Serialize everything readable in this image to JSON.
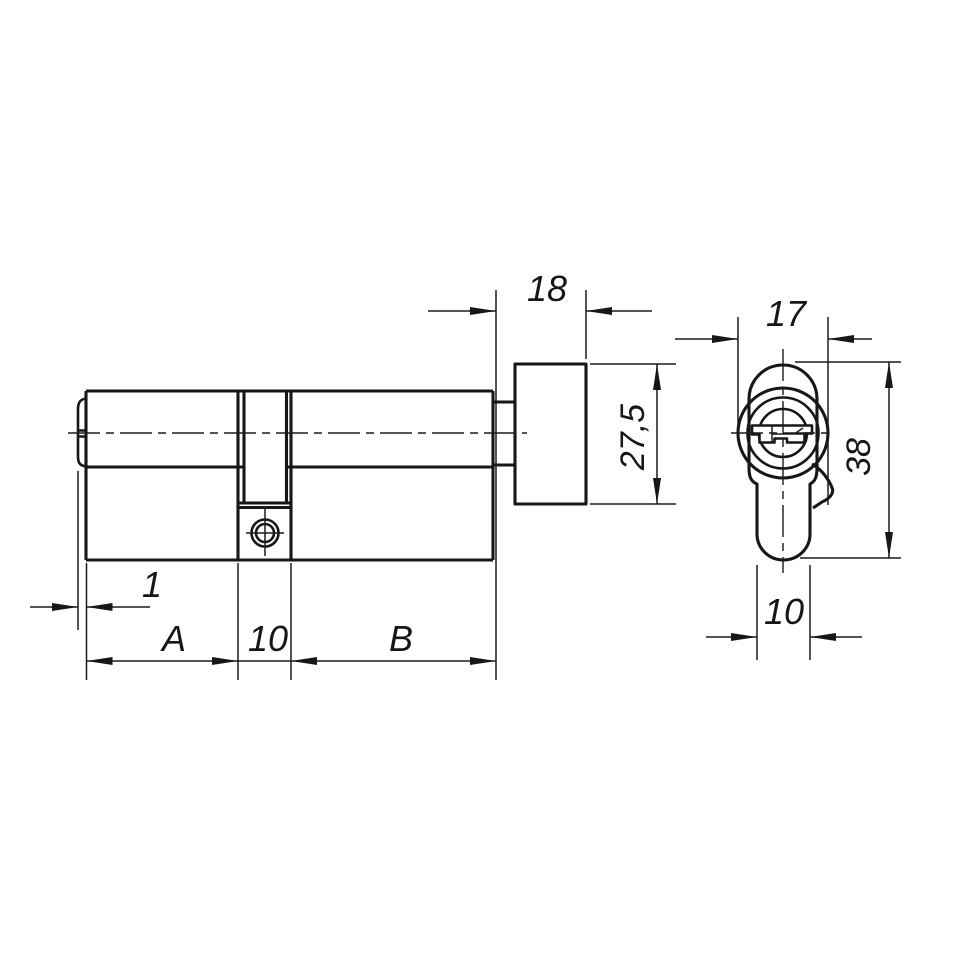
{
  "drawing": {
    "background": "#ffffff",
    "line_color": "#17171b",
    "labels": {
      "tip_width": "1",
      "length_a": "A",
      "cam_width": "10",
      "length_b": "B",
      "thumbturn_length": "18",
      "thumbturn_height": "27,5",
      "profile_diameter": "17",
      "profile_height": "38",
      "foot_width": "10"
    }
  }
}
